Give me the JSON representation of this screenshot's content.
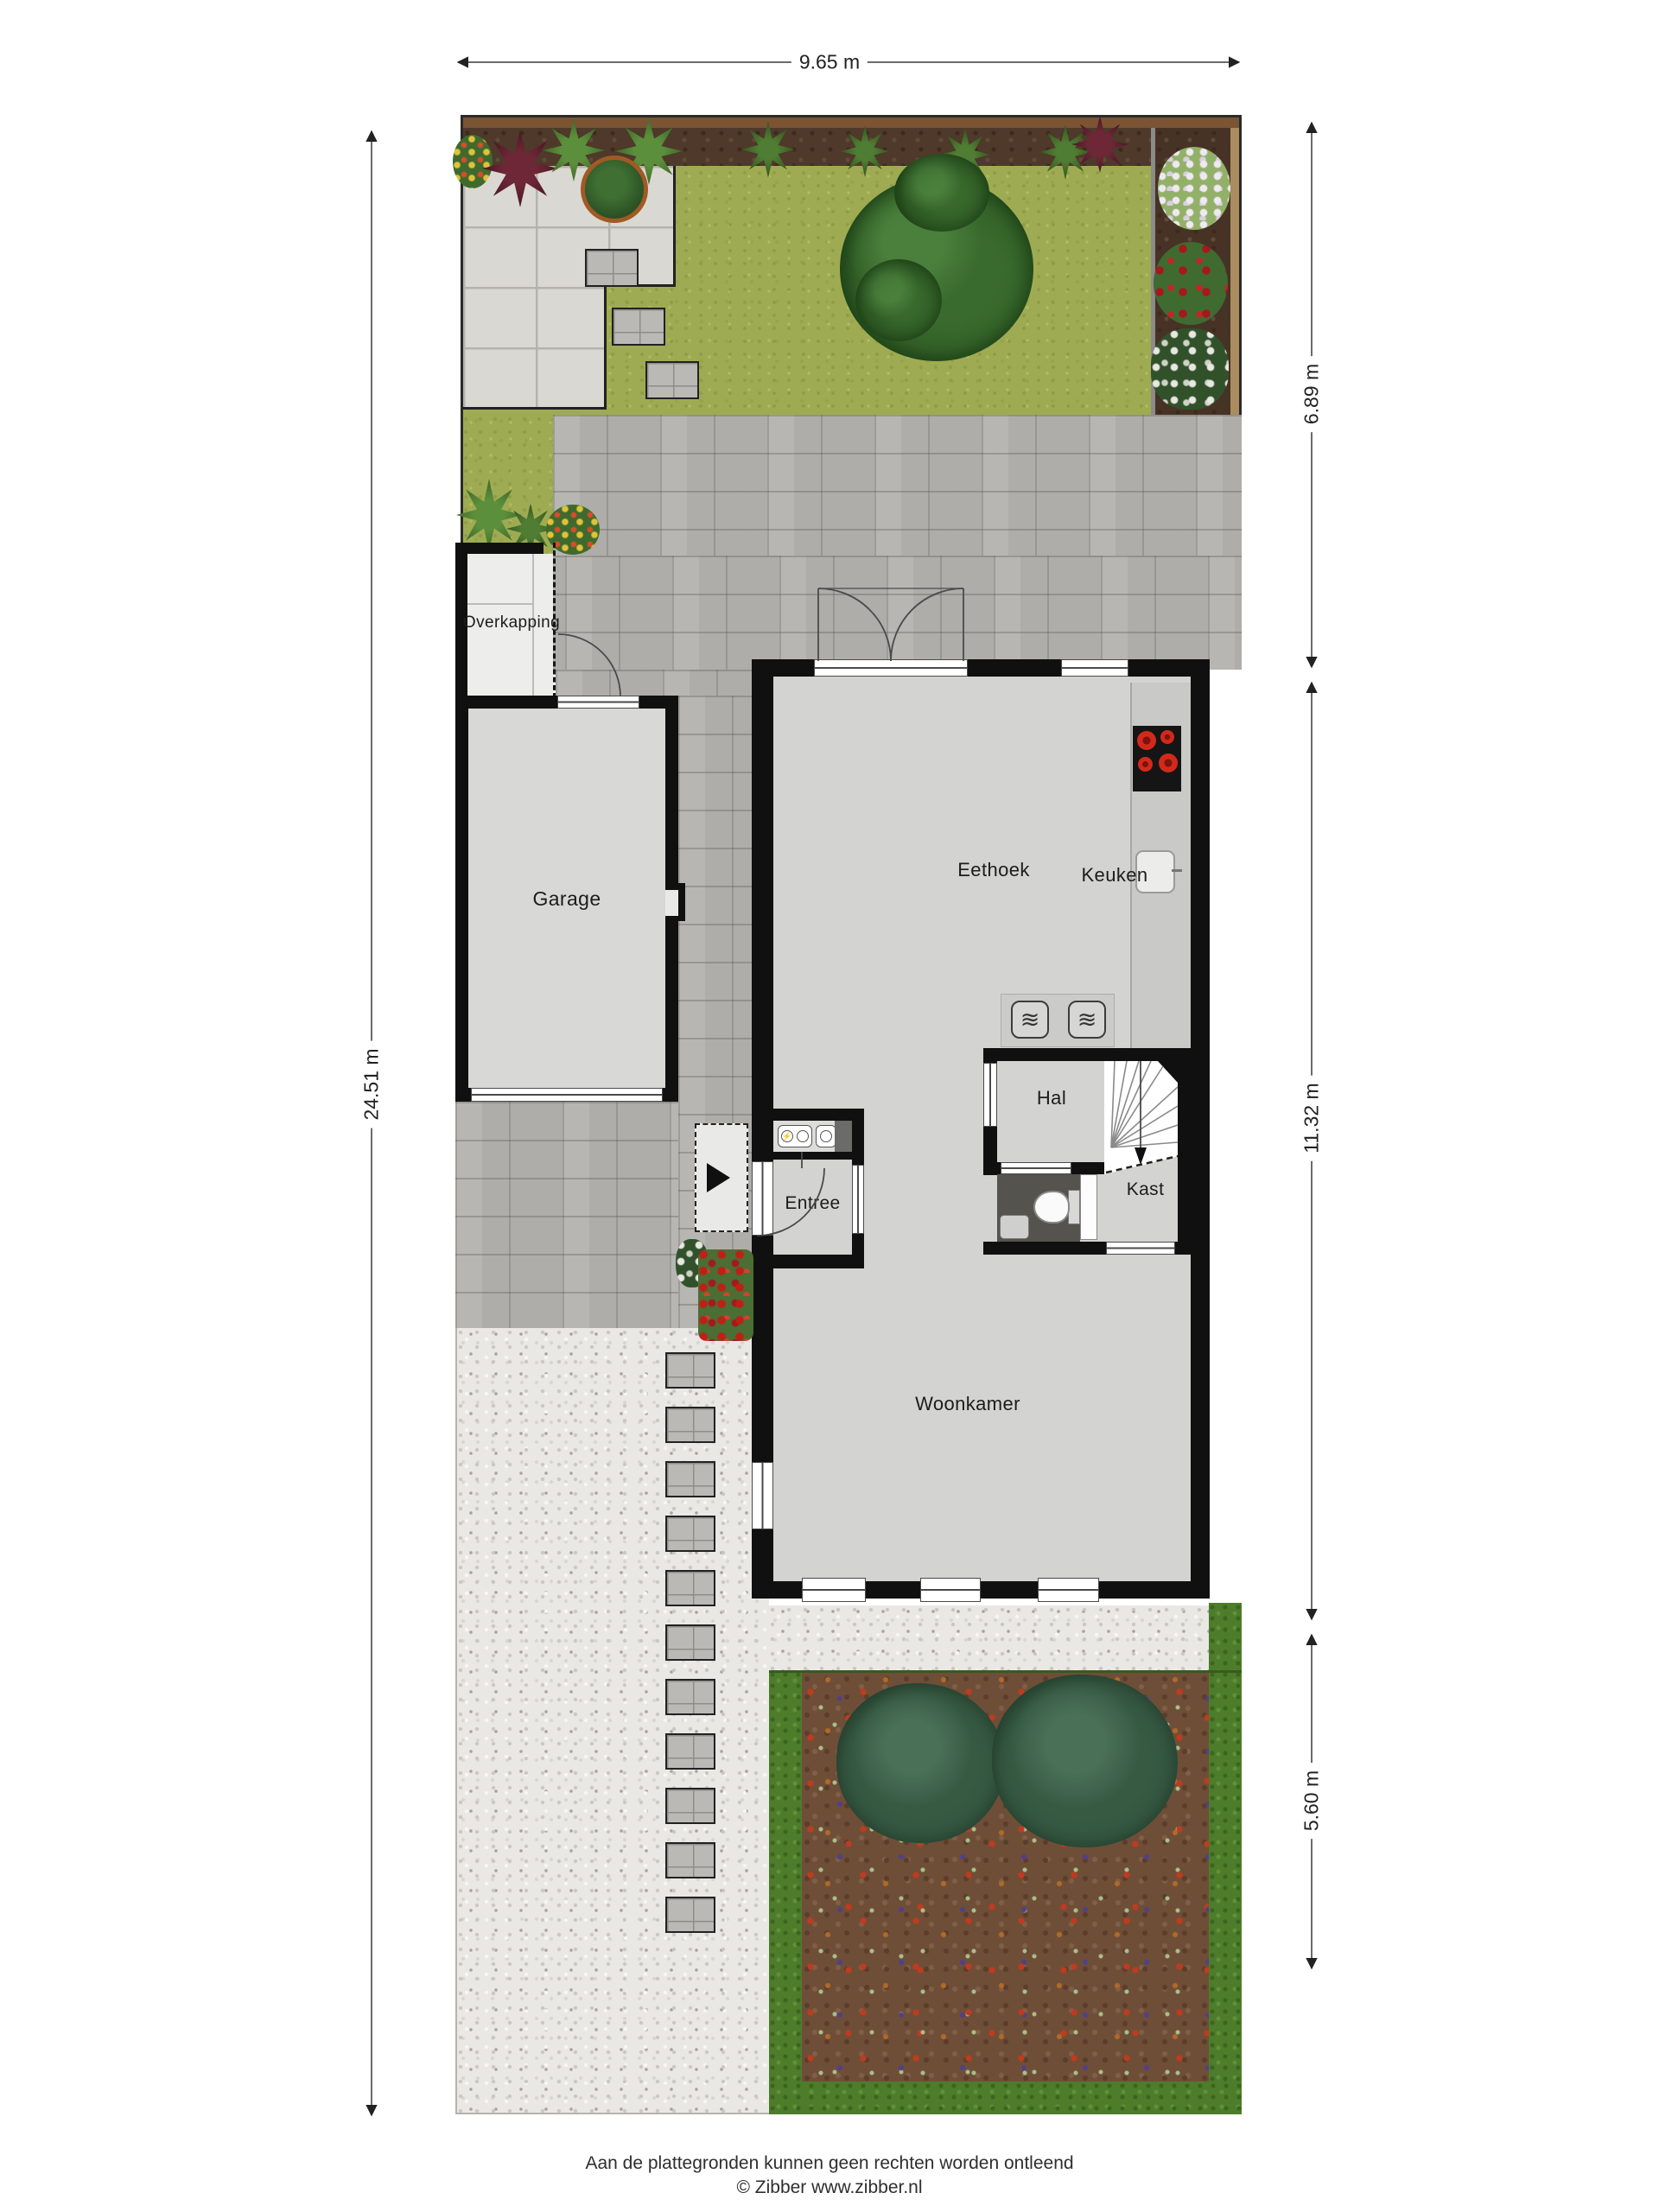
{
  "plan": {
    "dimensions": {
      "top_width": "9.65 m",
      "left_height": "24.51 m",
      "right_garden": "6.89 m",
      "right_house": "11.32 m",
      "right_front": "5.60 m"
    },
    "rooms": {
      "overkapping": "Overkapping",
      "garage": "Garage",
      "eethoek": "Eethoek",
      "keuken": "Keuken",
      "hal": "Hal",
      "kast": "Kast",
      "entree": "Entree",
      "woonkamer": "Woonkamer"
    },
    "icons": {
      "appliance_waves": "≋",
      "power_meter": "⚡",
      "entrance_arrow": "▶"
    },
    "colors": {
      "wall": "#101010",
      "floor": "#d3d3d1",
      "pavers": "#b7b6b2",
      "lawn": "#9fab52",
      "hedge": "#4d7c2a",
      "soil": "#6f4e38",
      "burner_red": "#d3291b"
    },
    "footer": {
      "disclaimer": "Aan de plattegronden kunnen geen rechten worden ontleend",
      "copyright": "© Zibber www.zibber.nl"
    }
  }
}
